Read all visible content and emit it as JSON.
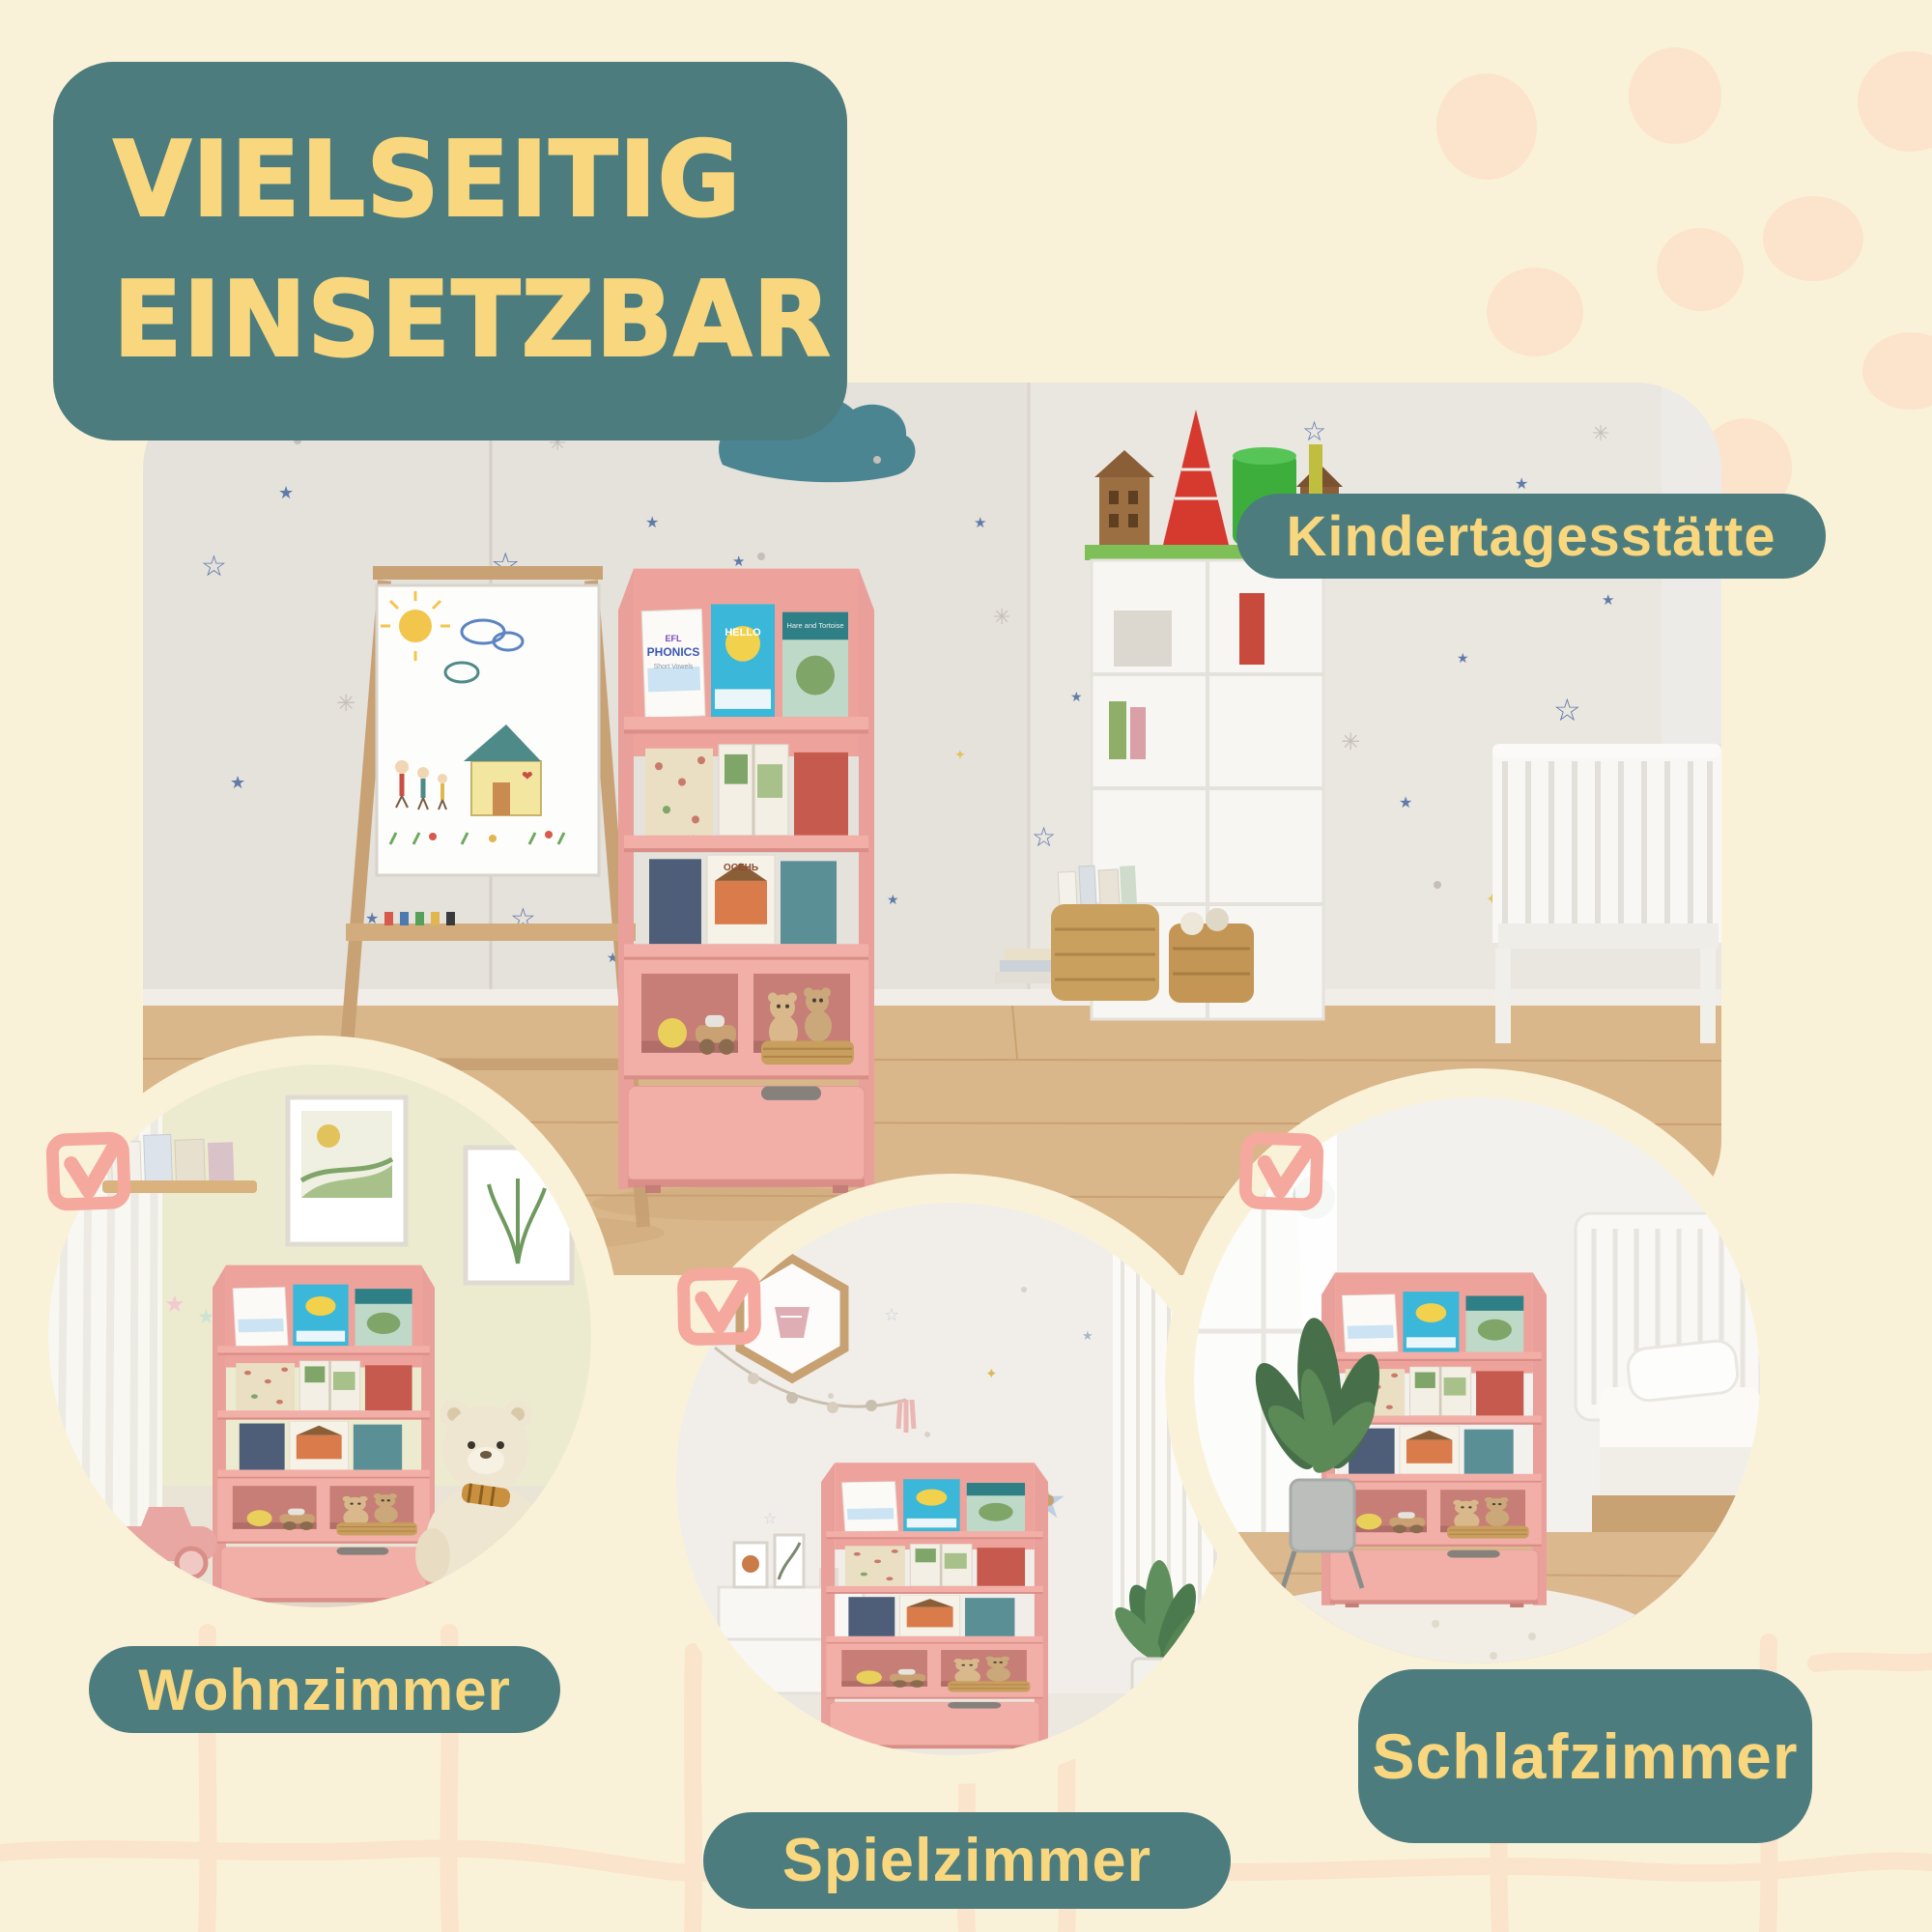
{
  "palette": {
    "background": "#FAF2D8",
    "teal": "#4C7C7E",
    "yellow": "#F9D77E",
    "pink_accent": "#F5A89D",
    "shelf_pink": "#F2AFA7",
    "peach_decor": "#FBE4CB",
    "wall_gray": "#E5E1DB",
    "wood_floor": "#DAB78A"
  },
  "title": {
    "line1": "VIELSEITIG",
    "line2": "EINSETZBAR"
  },
  "scenes": {
    "main": {
      "label": "Kindertagesstätte"
    },
    "living": {
      "label": "Wohnzimmer"
    },
    "play": {
      "label": "Spielzimmer"
    },
    "sleep": {
      "label": "Schlafzimmer"
    }
  },
  "checkboxes": {
    "icon": "checkbox-checked-icon",
    "count": 3
  },
  "books": {
    "b1_publisher": "EFL",
    "b1": "PHONICS",
    "b1_sub": "Short Vowels",
    "b2": "HELLO",
    "b2b": "Melody",
    "b3": "Hare and Tortoise",
    "b4": "ОСЕНЬ"
  }
}
